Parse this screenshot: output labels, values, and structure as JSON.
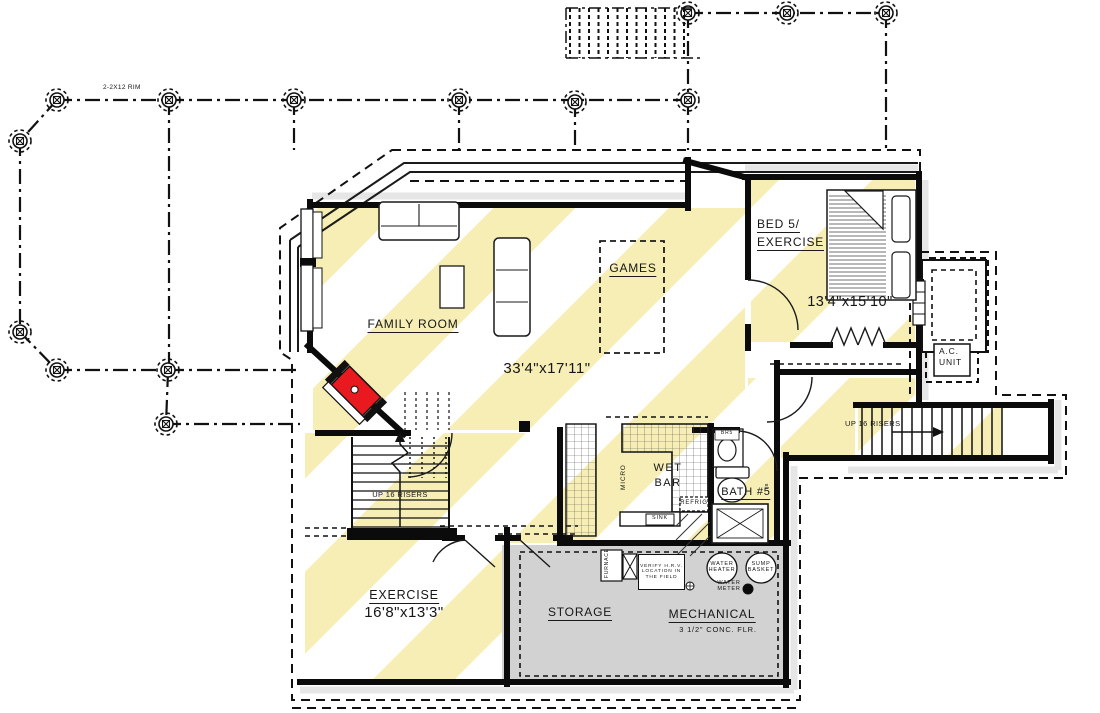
{
  "plan": {
    "title": "Basement Floor Plan",
    "colors": {
      "hatch": "#f6eeb4",
      "mechanical": "#d2d2d2",
      "fireplace": "#e8191f",
      "wall": "#0b0b0b"
    },
    "deck": {
      "rim_label": "2-2X12 RIM"
    },
    "rooms": {
      "family": {
        "name": "FAMILY ROOM",
        "dims": "33'4\"x17'11\""
      },
      "games": {
        "name": "GAMES"
      },
      "bed5": {
        "name_line1": "BED 5/",
        "name_line2": "EXERCISE",
        "dims": "13'4\"x15'10\""
      },
      "exercise": {
        "name": "EXERCISE",
        "dims": "16'8\"x13'3\""
      },
      "storage": {
        "name": "STORAGE"
      },
      "mechanical": {
        "name": "MECHANICAL",
        "floor_note": "3 1/2\" CONC. FLR."
      },
      "bath5": {
        "name": "BATH #5",
        "towel_bar": "TB",
        "vanity": "BR5"
      },
      "wet_bar": {
        "line1": "WET",
        "line2": "BAR",
        "micro": "MICRO",
        "refrig": "REFRIG",
        "sink": "SINK"
      }
    },
    "stairs": {
      "left": "UP 16 RISERS",
      "right": "UP 16 RISERS"
    },
    "equipment": {
      "ac_line1": "A.C.",
      "ac_line2": "UNIT",
      "furnace": "FURNACE",
      "hrv_line1": "VERIFY H.R.V.",
      "hrv_line2": "LOCATION IN",
      "hrv_line3": "THE FIELD",
      "water_heater_line1": "WATER",
      "water_heater_line2": "HEATER",
      "sump_line1": "SUMP",
      "sump_line2": "BASKET",
      "water_meter_line1": "WATER",
      "water_meter_line2": "METER"
    }
  }
}
